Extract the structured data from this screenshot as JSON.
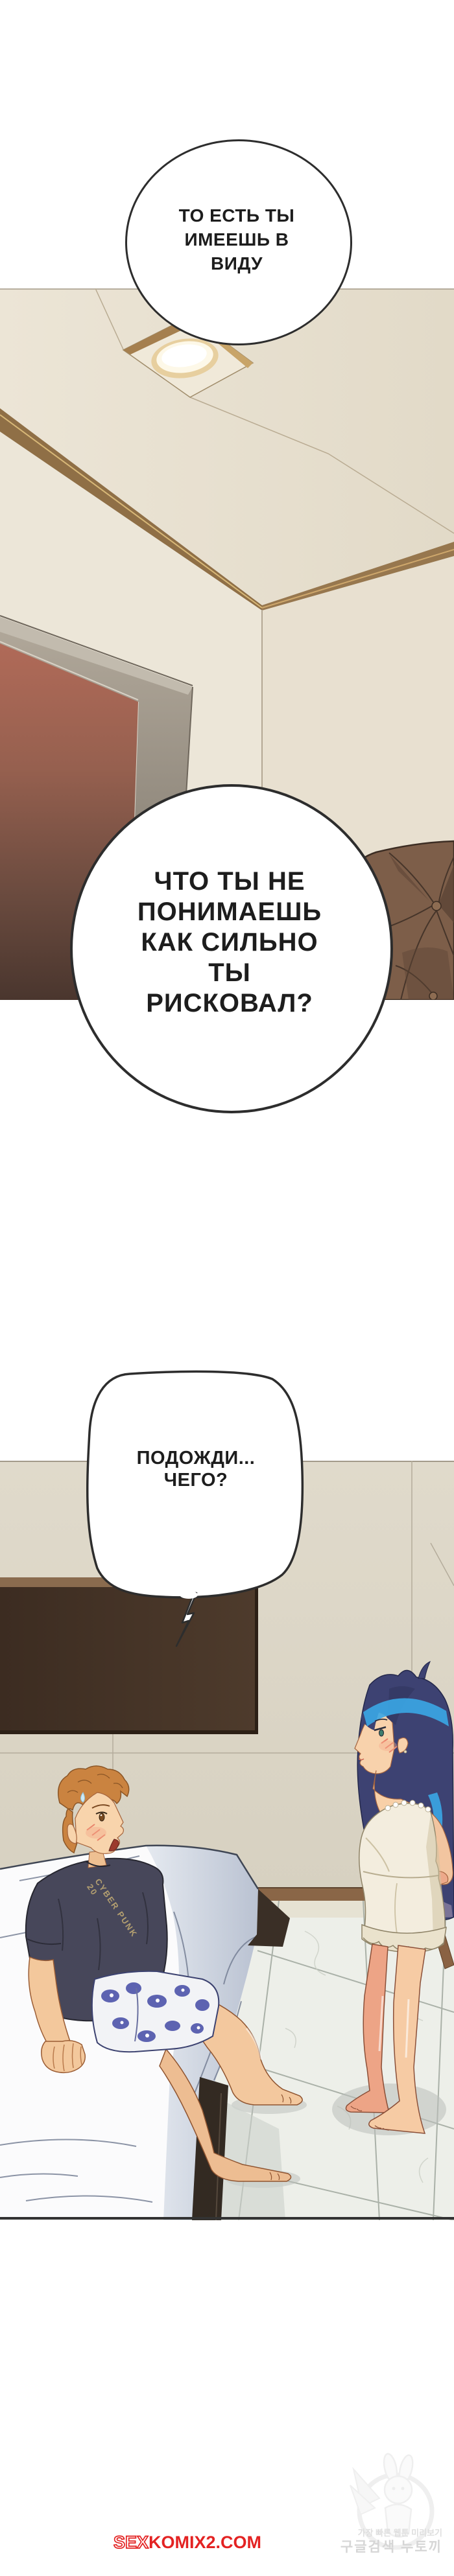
{
  "bubbles": {
    "bubble1": {
      "lines": [
        "ТО ЕСТЬ ТЫ",
        "ИМЕЕШЬ В",
        "ВИДУ"
      ]
    },
    "bubble2": {
      "lines": [
        "ЧТО ТЫ НЕ",
        "ПОНИМАЕШЬ",
        "КАК СИЛЬНО",
        "ТЫ",
        "РИСКОВАЛ?"
      ]
    },
    "bubble3": {
      "lines": [
        "ПОДОЖДИ...",
        "ЧЕГО?"
      ]
    }
  },
  "boy": {
    "shirt_text": "CYBER PUNK 20"
  },
  "watermark": {
    "prefix": "SEX",
    "suffix": "KOMIX2.COM",
    "color": "#e32222"
  },
  "site_logo": {
    "tagline": "가장 빠른 웹툰 미리보기",
    "name": "구글검색 누토끼"
  },
  "colors": {
    "ceiling": "#e8e1d1",
    "wall": "#ece5d7",
    "molding": "#8f6f46",
    "door": "#a96а54",
    "couch": "#7d5e49",
    "tv": "#493729",
    "scene_wall": "#dcd6c7",
    "floor": "#edefe9",
    "bed_sheet": "#fbfbfc",
    "boy_hair": "#ca8340",
    "girl_hair": "#3d4272",
    "girl_hair_highlight": "#3aa7e6",
    "watermark_red": "#e32222"
  }
}
